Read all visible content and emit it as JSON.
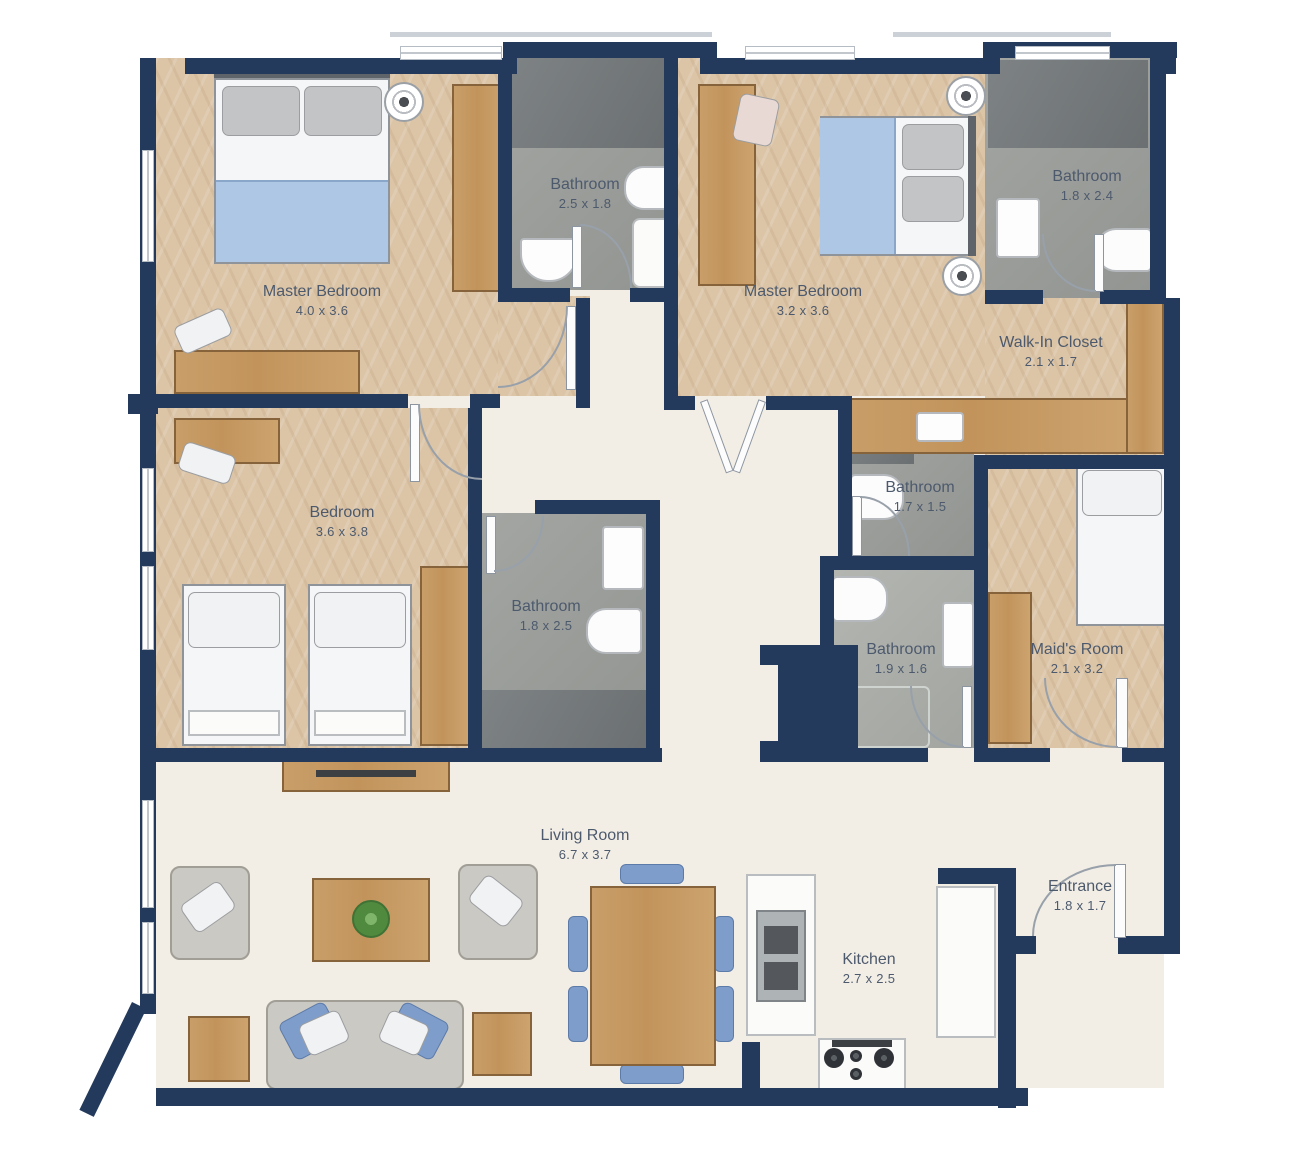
{
  "rooms": {
    "master_bedroom_1": {
      "name": "Master Bedroom",
      "dims": "4.0 x 3.6"
    },
    "bathroom_1": {
      "name": "Bathroom",
      "dims": "2.5 x 1.8"
    },
    "master_bedroom_2": {
      "name": "Master Bedroom",
      "dims": "3.2 x 3.6"
    },
    "bathroom_2": {
      "name": "Bathroom",
      "dims": "1.8 x 2.4"
    },
    "walk_in_closet": {
      "name": "Walk-In Closet",
      "dims": "2.1 x 1.7"
    },
    "bedroom": {
      "name": "Bedroom",
      "dims": "3.6 x 3.8"
    },
    "bathroom_3": {
      "name": "Bathroom",
      "dims": "1.8 x 2.5"
    },
    "bathroom_4": {
      "name": "Bathroom",
      "dims": "1.7 x 1.5"
    },
    "bathroom_5": {
      "name": "Bathroom",
      "dims": "1.9 x 1.6"
    },
    "maids_room": {
      "name": "Maid's Room",
      "dims": "2.1 x 3.2"
    },
    "living_room": {
      "name": "Living Room",
      "dims": "6.7 x 3.7"
    },
    "kitchen": {
      "name": "Kitchen",
      "dims": "2.7 x 2.5"
    },
    "entrance": {
      "name": "Entrance",
      "dims": "1.8 x 1.7"
    }
  },
  "colors": {
    "wall": "#243a5c",
    "bedroom_floor": "#dcc5a7",
    "bathroom_floor": "#9b9e9a",
    "shower_floor": "#74797b",
    "living_floor": "#f2eee6",
    "wood": "#c2945c",
    "duvet_blue": "#adc7e4",
    "chair_blue": "#7e9dca"
  }
}
